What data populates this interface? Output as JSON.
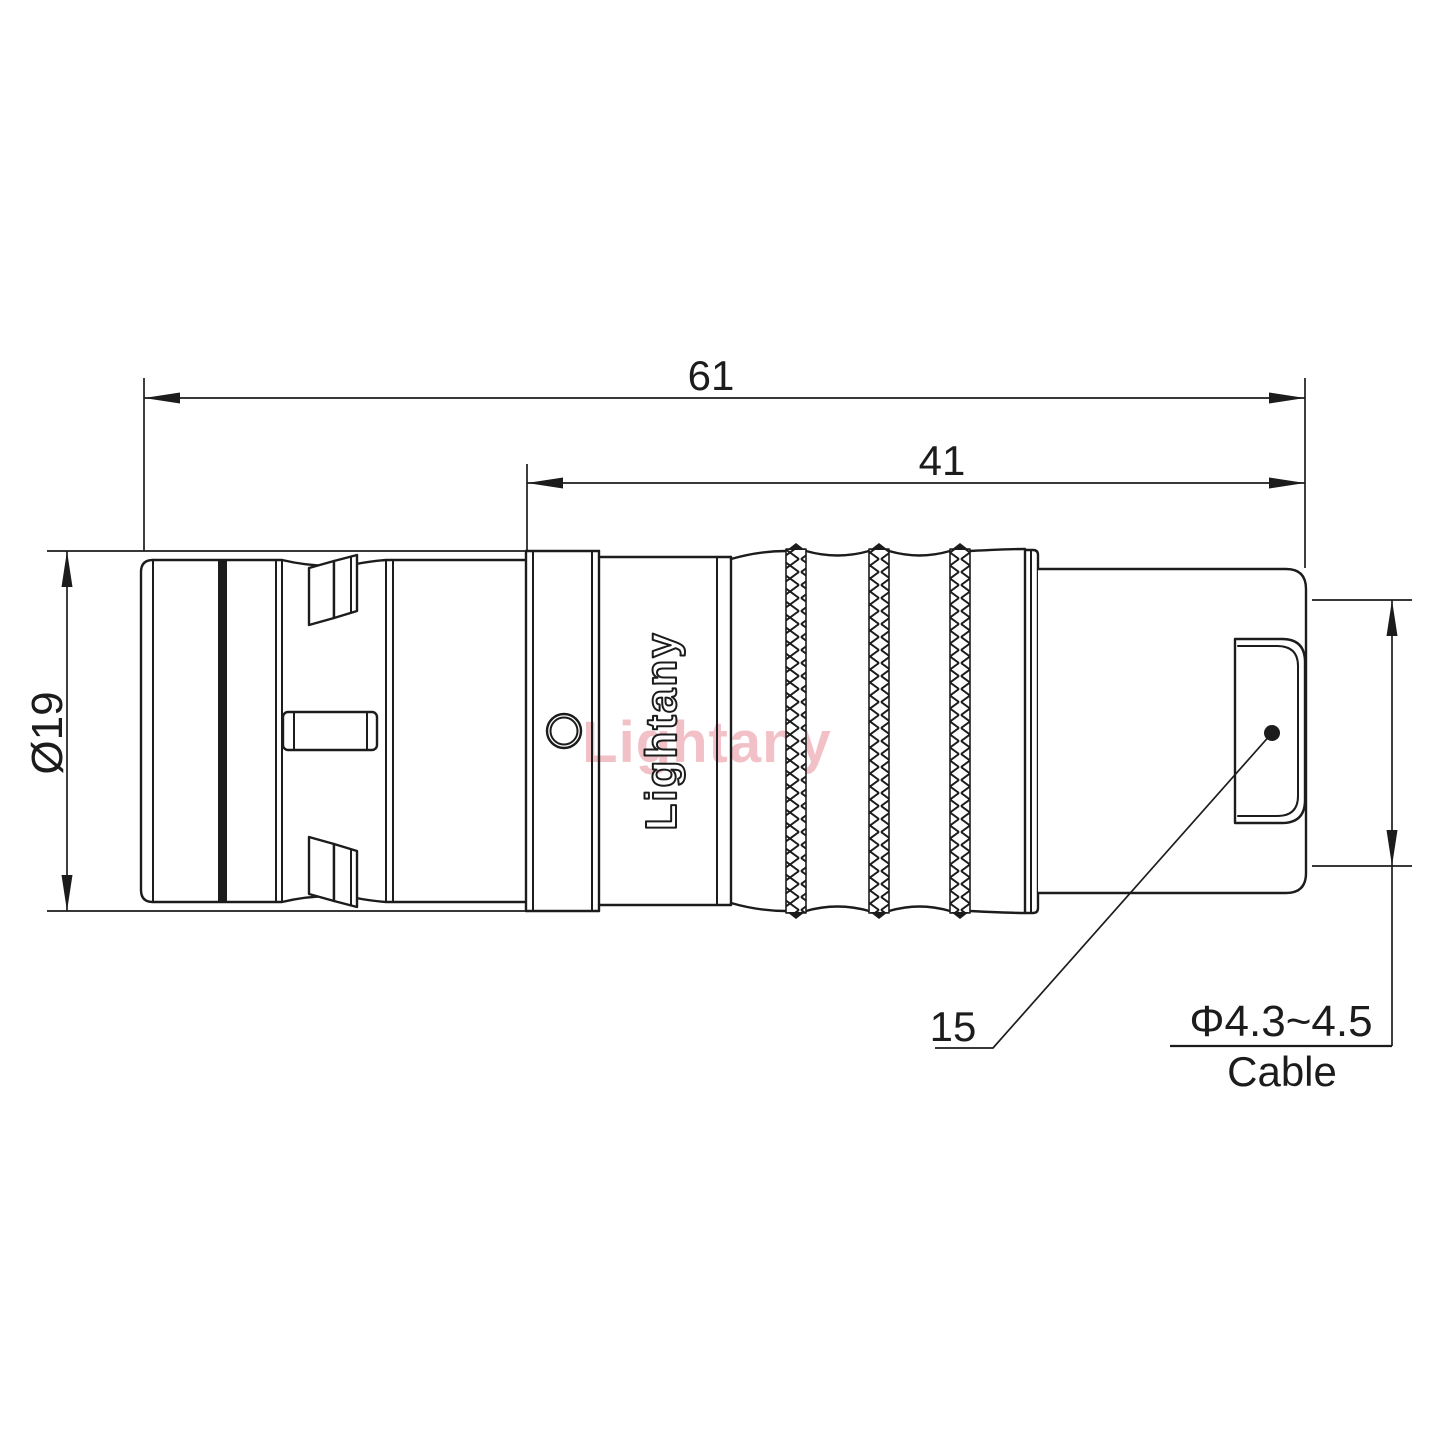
{
  "drawing": {
    "background": "#ffffff",
    "line_color": "#1c1c1c",
    "labels": {
      "overall_length": "61",
      "rear_length": "41",
      "outer_diameter": "Ø19",
      "nut_size": "15",
      "cable_range": "Φ4.3~4.5",
      "cable_word": "Cable"
    },
    "engraving": {
      "text": "Lightany"
    },
    "watermark": {
      "text": "Lightany",
      "color": "#f0b2ba"
    }
  }
}
